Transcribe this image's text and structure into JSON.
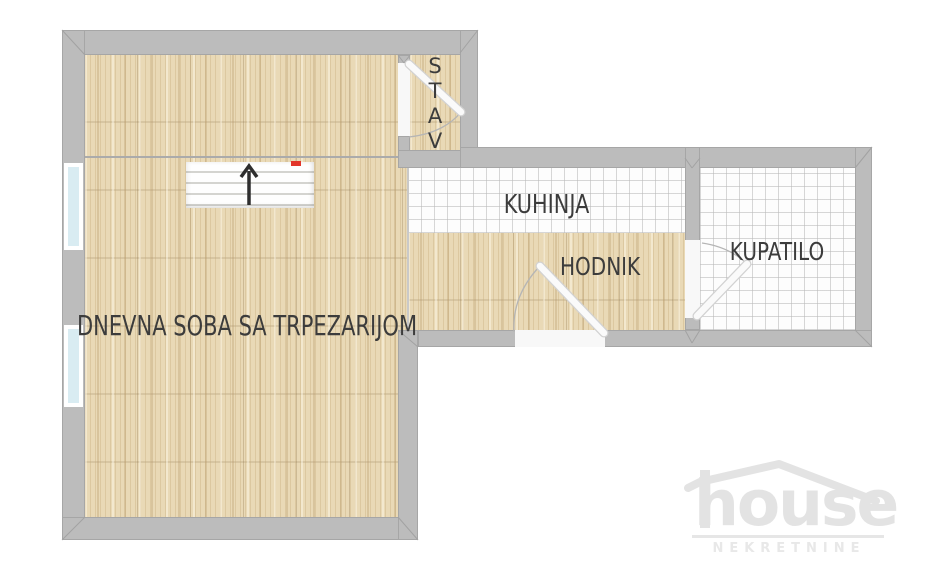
{
  "plan": {
    "living_room": {
      "label": "DNEVNA SOBA SA TRPEZARIJOM",
      "floor": "wood"
    },
    "kitchen": {
      "label": "KUHINJA",
      "floor": "tile"
    },
    "hallway": {
      "label": "HODNIK",
      "floor": "wood"
    },
    "bathroom": {
      "label": "KUPATILO",
      "floor": "tile"
    },
    "entry": {
      "vertical_label": "STAV",
      "letters": [
        "S",
        "T",
        "A",
        "V"
      ],
      "floor": "wood"
    },
    "features": {
      "stairs": {
        "direction": "up-arrow",
        "marker_color": "#e2352a"
      },
      "windows_on_left_wall": 2,
      "door_swings": [
        "entry-vestibule",
        "hallway-entrance",
        "bathroom"
      ]
    }
  },
  "watermark": {
    "name": "house",
    "tagline": "NEKRETNINE"
  },
  "colors": {
    "wall": "#bcbcbc",
    "wood_floor": "#e9d9b6",
    "tile_floor": "#fdfdfd",
    "window": "#d9ecf2",
    "label_text": "#3c3c3c",
    "stair_marker_red": "#e2352a",
    "watermark_gray": "#e3e3e3",
    "background": "#ffffff"
  }
}
